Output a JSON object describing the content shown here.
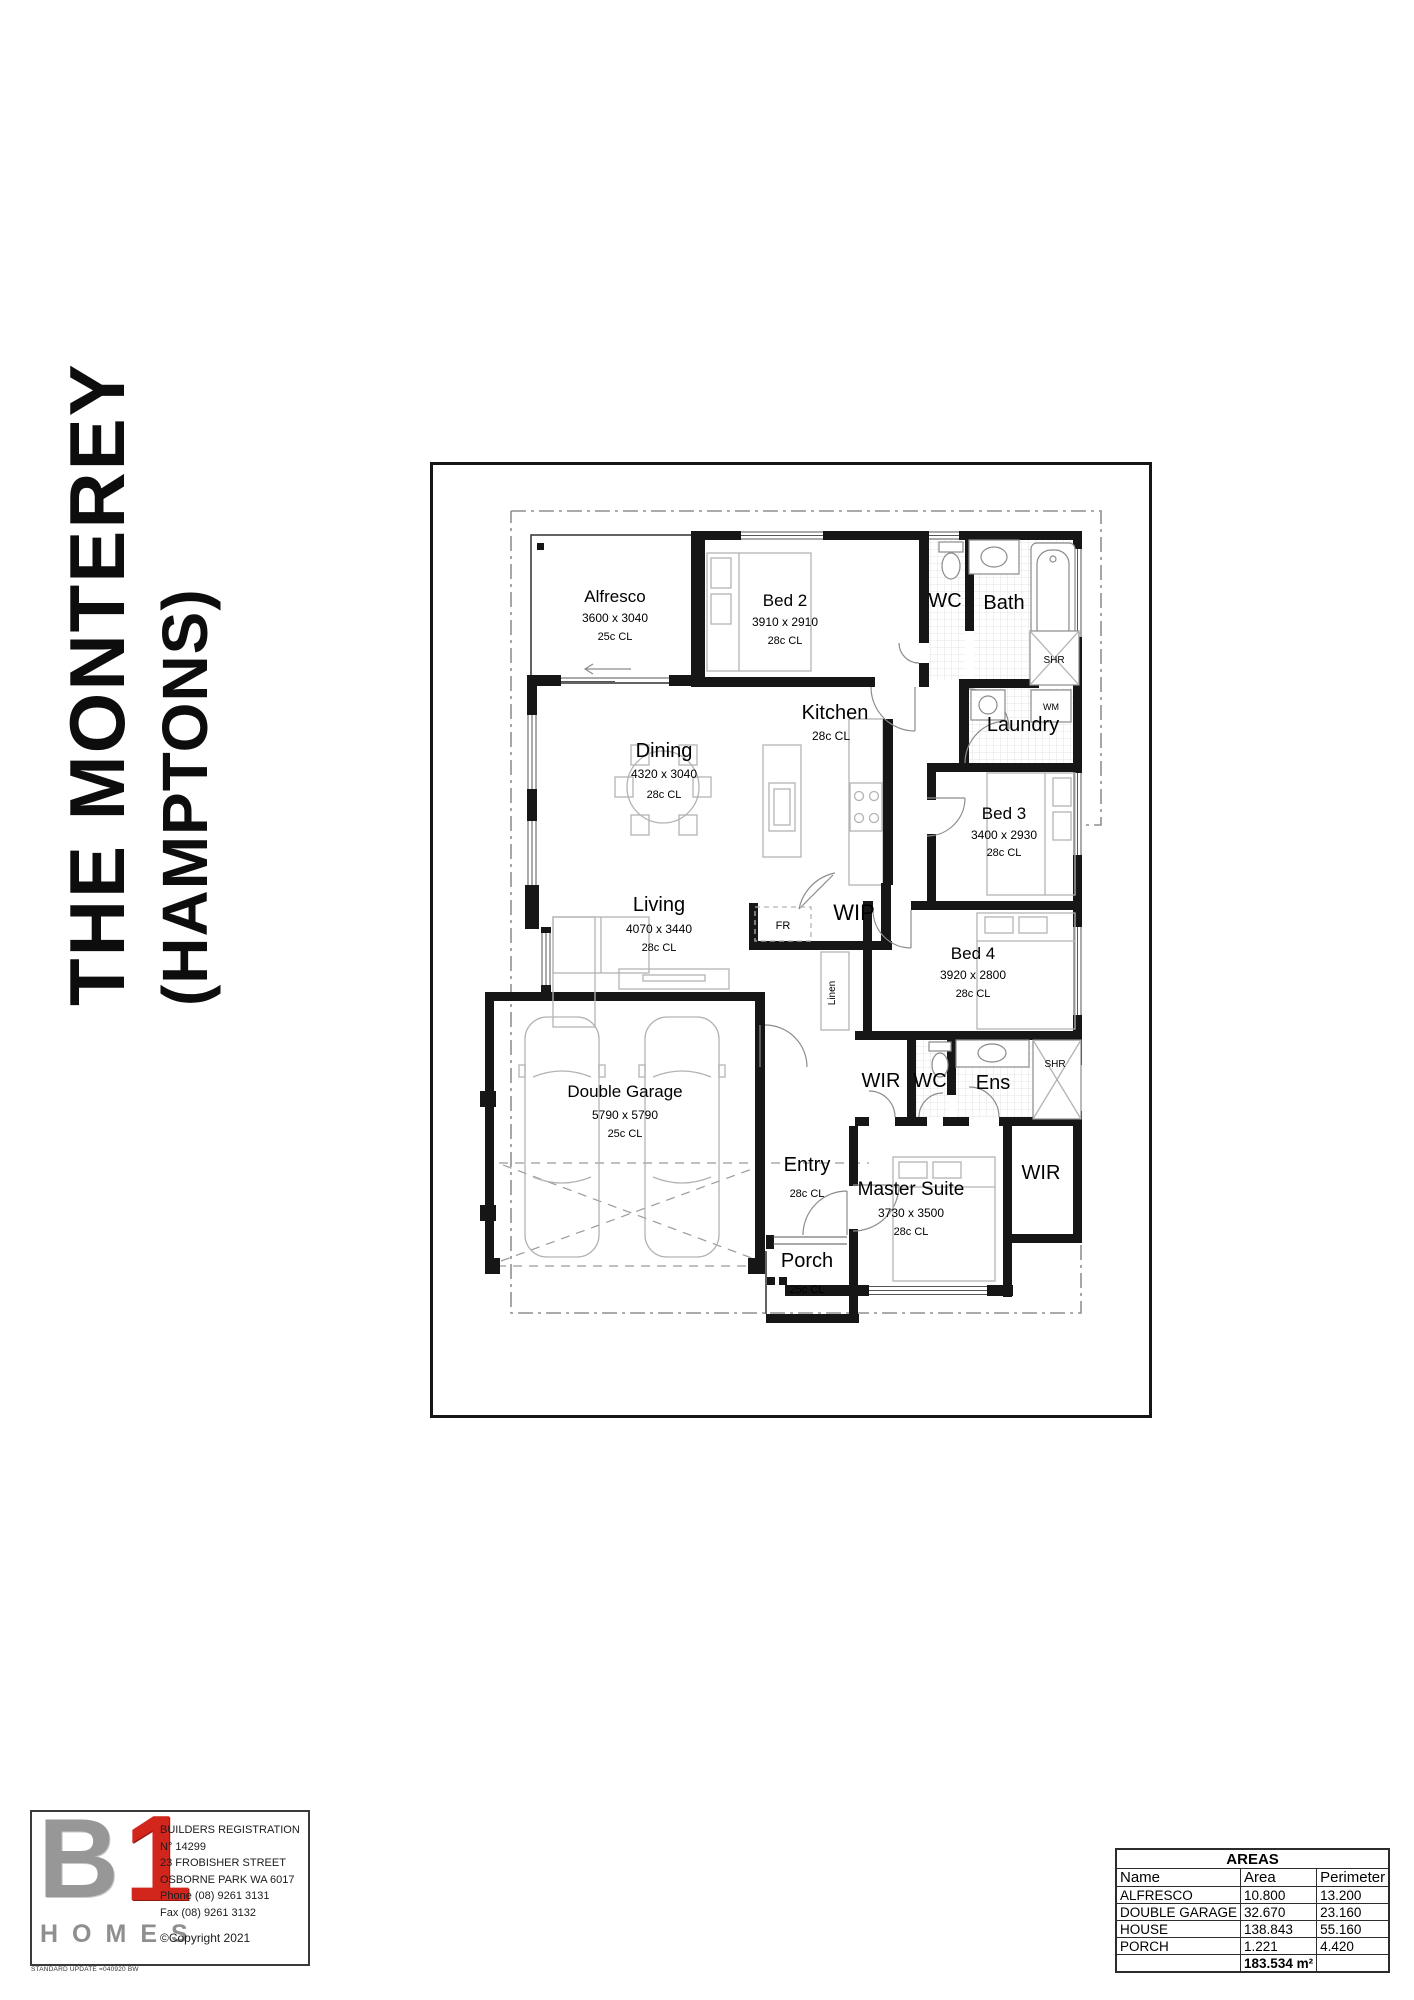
{
  "title": {
    "line1": "THE MONTEREY",
    "line2": "(HAMPTONS)"
  },
  "plan": {
    "rooms": {
      "alfresco": {
        "name": "Alfresco",
        "dims": "3600 x 3040",
        "ceiling": "25c CL"
      },
      "bed2": {
        "name": "Bed 2",
        "dims": "3910 x 2910",
        "ceiling": "28c CL"
      },
      "wc1": {
        "name": "WC"
      },
      "bath": {
        "name": "Bath"
      },
      "shr1": {
        "name": "SHR"
      },
      "wm": {
        "name": "WM"
      },
      "laundry": {
        "name": "Laundry"
      },
      "kitchen": {
        "name": "Kitchen",
        "ceiling": "28c CL"
      },
      "dining": {
        "name": "Dining",
        "dims": "4320 x 3040",
        "ceiling": "28c CL"
      },
      "bed3": {
        "name": "Bed 3",
        "dims": "3400 x 2930",
        "ceiling": "28c CL"
      },
      "living": {
        "name": "Living",
        "dims": "4070 x 3440",
        "ceiling": "28c CL"
      },
      "wip": {
        "name": "WIP"
      },
      "fr": {
        "name": "FR"
      },
      "linen": {
        "name": "Linen"
      },
      "bed4": {
        "name": "Bed 4",
        "dims": "3920 x 2800",
        "ceiling": "28c CL"
      },
      "wir1": {
        "name": "WIR"
      },
      "wc2": {
        "name": "WC"
      },
      "ens": {
        "name": "Ens"
      },
      "shr2": {
        "name": "SHR"
      },
      "garage": {
        "name": "Double Garage",
        "dims": "5790 x 5790",
        "ceiling": "25c CL"
      },
      "entry": {
        "name": "Entry",
        "ceiling": "28c CL"
      },
      "master": {
        "name": "Master Suite",
        "dims": "3730 x 3500",
        "ceiling": "28c CL"
      },
      "wir2": {
        "name": "WIR"
      },
      "porch": {
        "name": "Porch",
        "ceiling": "25c CL"
      }
    }
  },
  "footer": {
    "brand": {
      "b": "B",
      "one": "1",
      "homes": "HOMES"
    },
    "registration": [
      "BUILDERS REGISTRATION",
      "N° 14299",
      "23 FROBISHER STREET",
      "OSBORNE PARK  WA  6017",
      "Phone (08) 9261 3131",
      "Fax (08) 9261 3132"
    ],
    "copyright": "©Copyright 2021",
    "footnote": "STANDARD UPDATE =040920 BW"
  },
  "areas_table": {
    "title": "AREAS",
    "headers": [
      "Name",
      "Area",
      "Perimeter"
    ],
    "rows": [
      [
        "ALFRESCO",
        "10.800",
        "13.200"
      ],
      [
        "DOUBLE GARAGE",
        "32.670",
        "23.160"
      ],
      [
        "HOUSE",
        "138.843",
        "55.160"
      ],
      [
        "PORCH",
        "1.221",
        "4.420"
      ]
    ],
    "total_area": "183.534 m²"
  }
}
